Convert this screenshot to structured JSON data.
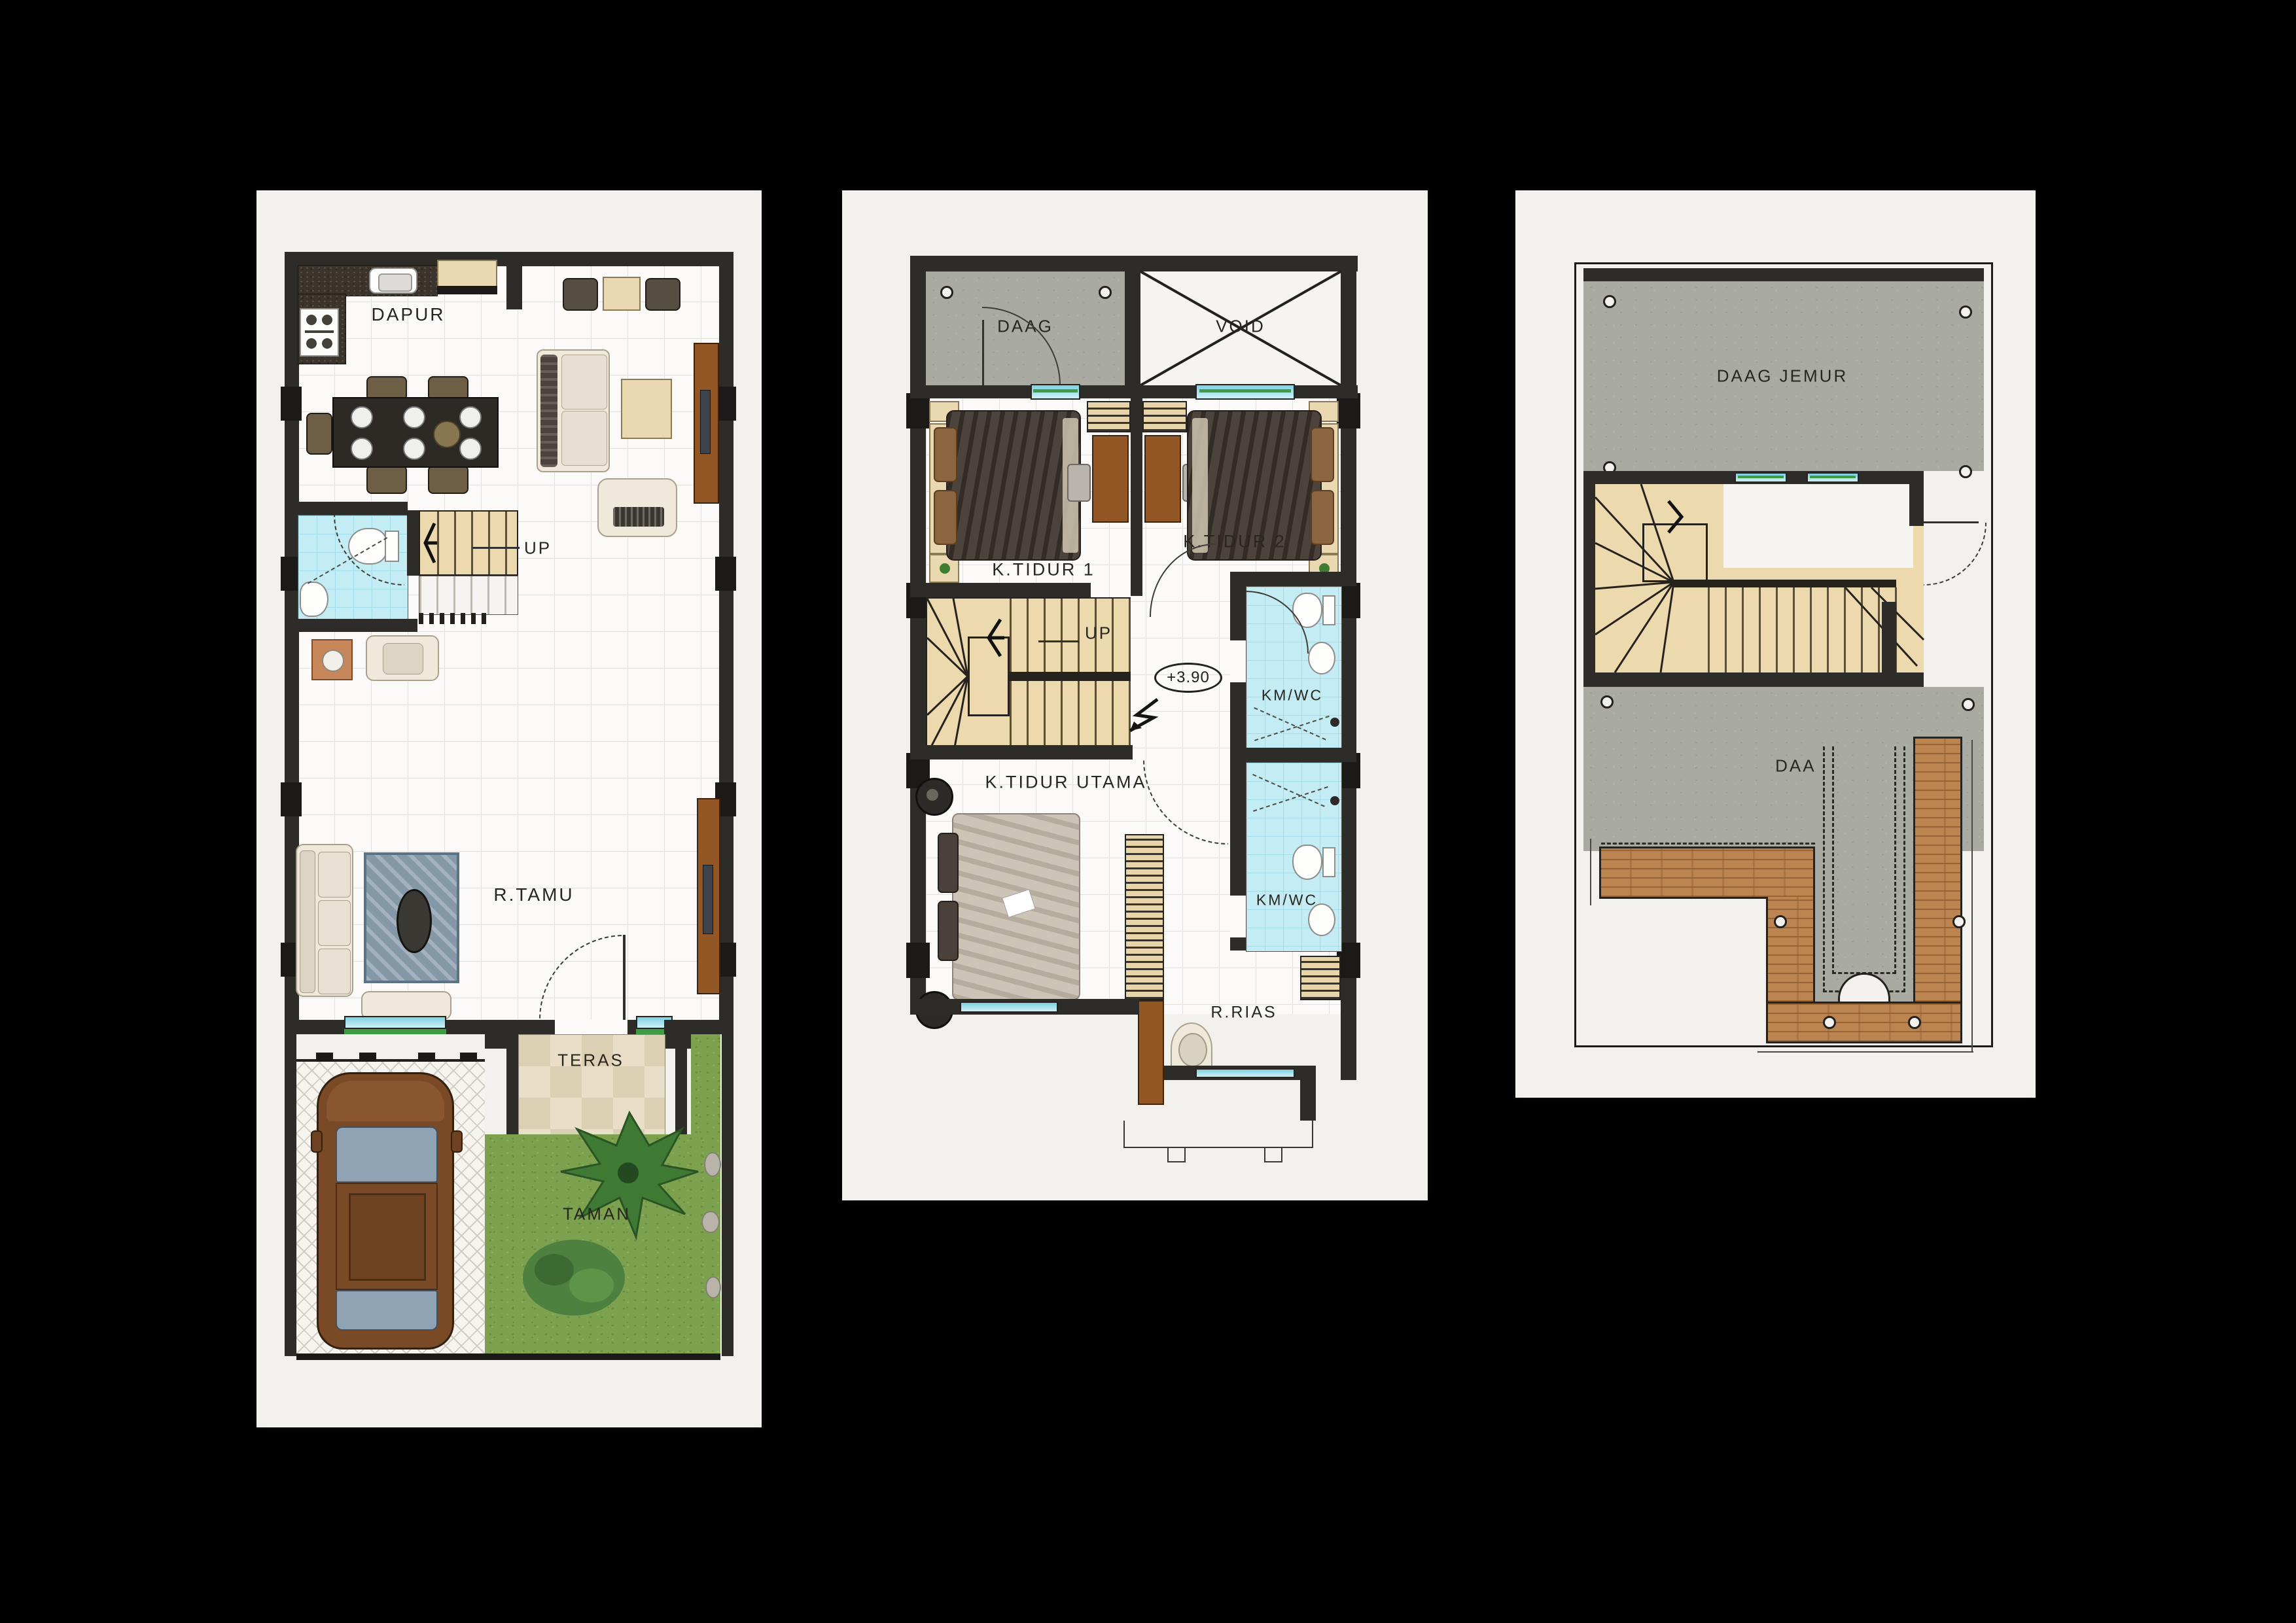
{
  "palette": {
    "background": "#000000",
    "panel": "#f3f1ed",
    "wall": "#2e2c28",
    "concrete": "#a9aba2",
    "grass": "#7da24f",
    "bathroom_tile": "#c3ecf4",
    "stair": "#ecd9ad",
    "roof_tile": "#bb8451",
    "wood_furniture": "#935625",
    "window_glass": "#9fdbe8",
    "window_sill": "#3f9b44"
  },
  "floor1": {
    "dapur": "DAPUR",
    "up": "UP",
    "r_tamu": "R.TAMU",
    "teras": "TERAS",
    "taman": "TAMAN"
  },
  "floor2": {
    "daag": "DAAG",
    "void": "VOID",
    "k_tidur_1": "K.TIDUR 1",
    "k_tidur_2": "K.TIDUR 2",
    "up": "UP",
    "elevation": "+3.90",
    "km_wc_upper": "KM/WC",
    "k_tidur_utama": "K.TIDUR UTAMA",
    "km_wc_lower": "KM/WC",
    "r_rias": "R.RIAS"
  },
  "roof": {
    "daag_jemur": "DAAG JEMUR",
    "daag": "DAAG"
  }
}
